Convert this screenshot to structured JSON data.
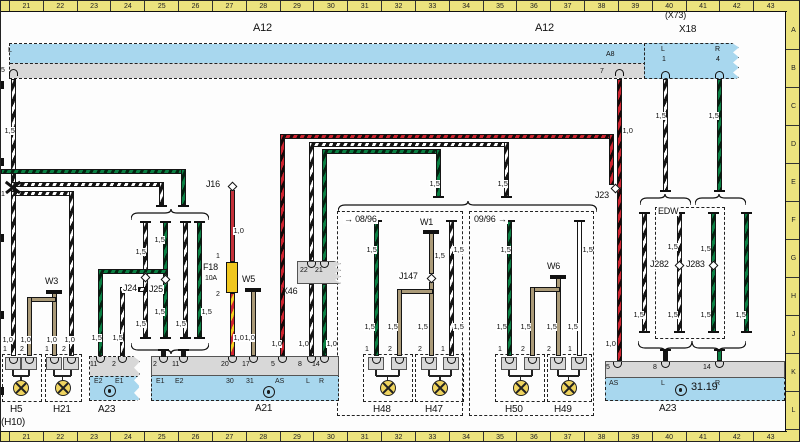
{
  "diagram": {
    "a12_label": "A12",
    "x73_label": "(X73)",
    "x18_label": "X18",
    "x46_label": "X46",
    "edw_label": "EDW",
    "version_until": "→ 08/96",
    "version_from": "09/96 →",
    "ref_3119": "31.19",
    "splice_1": "1"
  },
  "ruler": {
    "numbers": [
      "21",
      "22",
      "23",
      "24",
      "25",
      "26",
      "27",
      "28",
      "29",
      "30",
      "31",
      "32",
      "33",
      "34",
      "35",
      "36",
      "37",
      "38",
      "39",
      "40",
      "41",
      "42",
      "43"
    ],
    "letters": [
      "A",
      "B",
      "C",
      "D",
      "E",
      "F",
      "G",
      "H",
      "J",
      "K",
      "L"
    ]
  },
  "gauge": {
    "g15": "1,5",
    "g10": "1,0"
  },
  "fuse": {
    "label": "F18",
    "rating": "10A",
    "pin1": "1",
    "pin2": "2"
  },
  "grounds": {
    "w1": "W1",
    "w3": "W3",
    "w5": "W5",
    "w6": "W6"
  },
  "plugs": {
    "j16": "J16",
    "j23": "J23",
    "j24": "J24",
    "j25": "J25",
    "j147": "J147",
    "j282": "J282",
    "j283": "J283"
  },
  "a12": {
    "pin_l": "L",
    "pin_5": "5",
    "pin_a8": "A8",
    "pin_7": "7"
  },
  "x18": {
    "pin_l": "L",
    "pin_1": "1",
    "pin_r": "R",
    "pin_4": "4"
  },
  "x46": {
    "pin_22": "22",
    "pin_21": "21"
  },
  "h5": {
    "label": "H5",
    "sub": "(H10)",
    "pin1": "1",
    "pin2": "2"
  },
  "h21": {
    "label": "H21",
    "pin1": "1",
    "pin2": "2"
  },
  "h48": {
    "label": "H48",
    "pin1": "1",
    "pin2": "2"
  },
  "h47": {
    "label": "H47",
    "pin1": "1",
    "pin2": "2"
  },
  "h50": {
    "label": "H50",
    "pin1": "1",
    "pin2": "2"
  },
  "h49": {
    "label": "H49",
    "pin1": "1",
    "pin2": "2"
  },
  "a23l": {
    "label": "A23",
    "pin11": "11",
    "pin2": "2",
    "e2": "E2",
    "e1": "E1"
  },
  "a21": {
    "label": "A21",
    "p2": "2",
    "p11": "11",
    "p20": "20",
    "p17": "17",
    "p5": "5",
    "p8": "8",
    "p14": "14",
    "e1": "E1",
    "e2": "E2",
    "t30": "30",
    "t31": "31",
    "as": "AS",
    "l": "L",
    "r": "R"
  },
  "a23r": {
    "label": "A23",
    "p5": "5",
    "p8": "8",
    "p14": "14",
    "as": "AS",
    "l": "L",
    "r": "R"
  },
  "colors": {
    "band_blue": "#a8d7ee",
    "band_gray": "#d8d8d8",
    "ruler_yellow": "#ece37e",
    "wire_green": "#0a8043",
    "wire_red": "#cf2430",
    "wire_brown": "#ab9b79",
    "fuse_yellow": "#f0c71f"
  }
}
